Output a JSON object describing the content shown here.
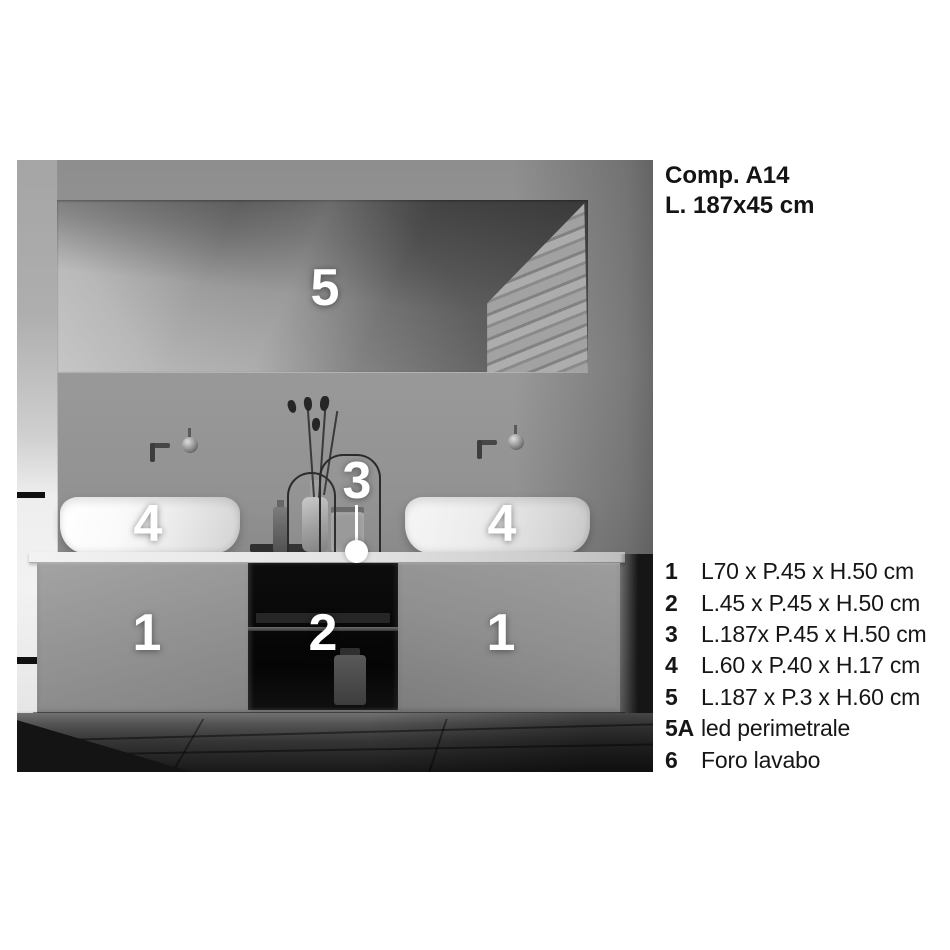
{
  "header": {
    "model": "Comp. A14",
    "size": "L. 187x45 cm"
  },
  "photo": {
    "labels": [
      {
        "id": "mirror",
        "text": "5"
      },
      {
        "id": "basin-left",
        "text": "4"
      },
      {
        "id": "countertop",
        "text": "3"
      },
      {
        "id": "basin-right",
        "text": "4"
      },
      {
        "id": "door-left",
        "text": "1"
      },
      {
        "id": "open-shelf",
        "text": "2"
      },
      {
        "id": "door-right",
        "text": "1"
      }
    ]
  },
  "legend": {
    "items": [
      {
        "num": "1",
        "desc": "L70 x P.45 x H.50 cm"
      },
      {
        "num": "2",
        "desc": "L.45 x P.45 x H.50 cm"
      },
      {
        "num": "3",
        "desc": "L.187x P.45 x H.50 cm"
      },
      {
        "num": "4",
        "desc": "L.60 x P.40 x H.17 cm"
      },
      {
        "num": "5",
        "desc": "L.187 x P.3 x H.60 cm"
      },
      {
        "num": "5A",
        "desc": "led perimetrale"
      },
      {
        "num": "6",
        "desc": "Foro lavabo"
      }
    ]
  },
  "colors": {
    "background": "#ffffff",
    "text": "#161616",
    "callout_label": "#ffffff"
  }
}
